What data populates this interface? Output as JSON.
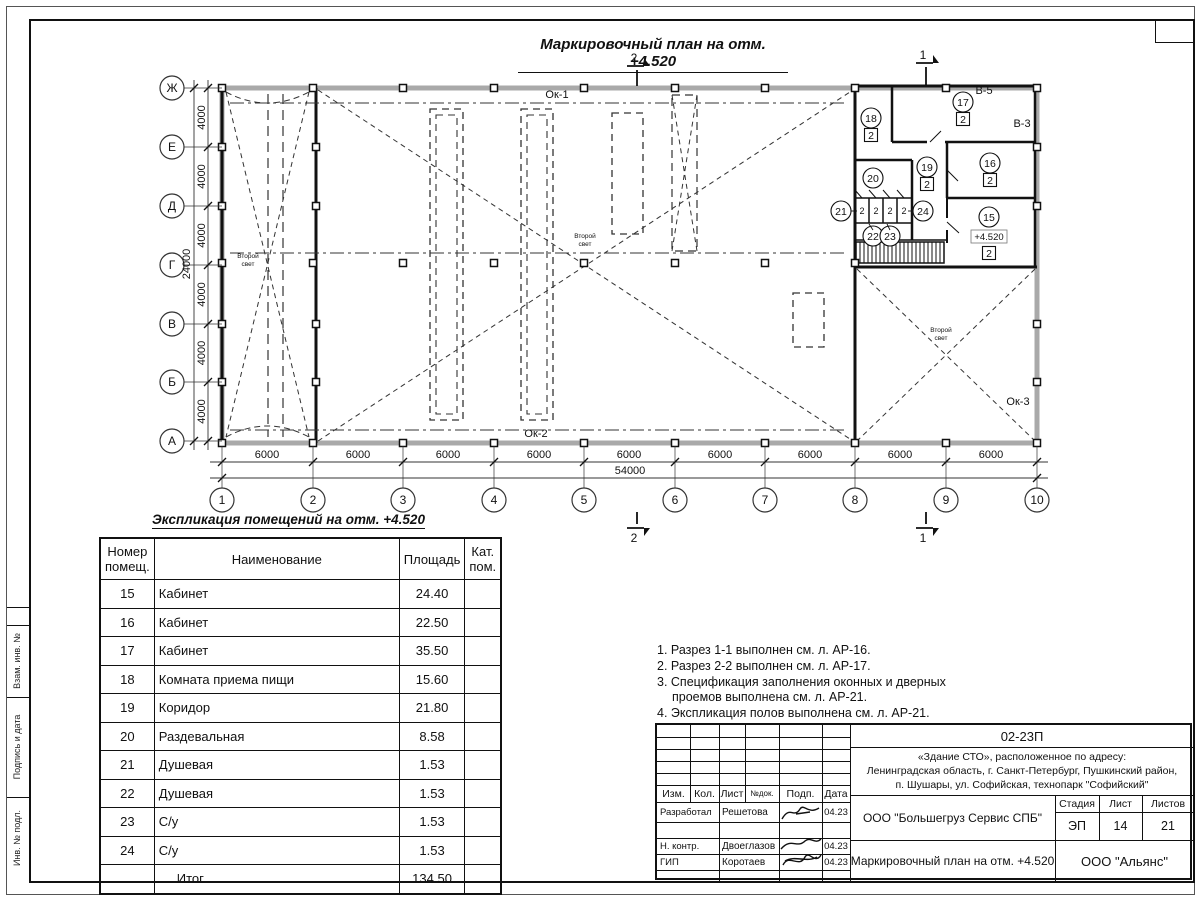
{
  "frame": {
    "side_labels": [
      "Взам. инв. №",
      "Подпись и дата",
      "Инв. № подл."
    ]
  },
  "plan": {
    "title": "Маркировочный план на отм. +4.520",
    "axes_rows": [
      "Ж",
      "Е",
      "Д",
      "Г",
      "В",
      "Б",
      "А"
    ],
    "axes_cols": [
      "1",
      "2",
      "3",
      "4",
      "5",
      "6",
      "7",
      "8",
      "9",
      "10"
    ],
    "dim_bay_h": "6000",
    "dim_total_h": "54000",
    "dim_bay_v": "4000",
    "dim_total_v": "24000",
    "ok1": "Ок-1",
    "ok2": "Ок-2",
    "ok3": "Ок-3",
    "b5": "В-5",
    "b3": "В-3",
    "second_light_line1": "Второй",
    "second_light_line2": "свет",
    "elevation": "+4.520",
    "floor_mark": "2",
    "section_1": "1",
    "section_2": "2",
    "room_numbers": [
      "15",
      "16",
      "17",
      "18",
      "19",
      "20",
      "21",
      "22",
      "23",
      "24"
    ]
  },
  "table": {
    "title": "Экспликация помещений на отм. +4.520",
    "headers": [
      "Номер\nпомещ.",
      "Наименование",
      "Площадь",
      "Кат.\nпом."
    ],
    "rows": [
      {
        "num": "15",
        "name": "Кабинет",
        "area": "24.40",
        "cat": ""
      },
      {
        "num": "16",
        "name": "Кабинет",
        "area": "22.50",
        "cat": ""
      },
      {
        "num": "17",
        "name": "Кабинет",
        "area": "35.50",
        "cat": ""
      },
      {
        "num": "18",
        "name": "Комната приема пищи",
        "area": "15.60",
        "cat": ""
      },
      {
        "num": "19",
        "name": "Коридор",
        "area": "21.80",
        "cat": ""
      },
      {
        "num": "20",
        "name": "Раздевальная",
        "area": "8.58",
        "cat": ""
      },
      {
        "num": "21",
        "name": "Душевая",
        "area": "1.53",
        "cat": ""
      },
      {
        "num": "22",
        "name": "Душевая",
        "area": "1.53",
        "cat": ""
      },
      {
        "num": "23",
        "name": "С/у",
        "area": "1.53",
        "cat": ""
      },
      {
        "num": "24",
        "name": "С/у",
        "area": "1.53",
        "cat": ""
      }
    ],
    "total": {
      "num": "",
      "name": "Итог",
      "area": "134.50",
      "cat": ""
    }
  },
  "notes": {
    "line1": "1. Разрез 1-1 выполнен см. л. АР-16.",
    "line2": "2. Разрез 2-2 выполнен см. л. АР-17.",
    "line3": "3. Спецификация заполнения оконных и дверных",
    "line4": "проемов выполнена см. л. АР-21.",
    "line5": "4. Экспликация полов выполнена см. л. АР-21."
  },
  "titleblock": {
    "doc_number": "02-23П",
    "address_line1": "«Здание СТО», расположенное по адресу:",
    "address_line2": "Ленинградская область, г. Санкт-Петербург, Пушкинский район,",
    "address_line3": "п. Шушары, ул. Софийская, технопарк \"Софийский\"",
    "col_izm": "Изм.",
    "col_kol": "Кол.",
    "col_list": "Лист",
    "col_doc": "№док.",
    "col_podp": "Подп.",
    "col_data": "Дата",
    "role_developed": "Разработал",
    "name_developed": "Решетова",
    "date_developed": "04.23",
    "role_ncontr": "Н. контр.",
    "name_ncontr": "Двоеглазов",
    "date_ncontr": "04.23",
    "role_gip": "ГИП",
    "name_gip": "Коротаев",
    "date_gip": "04.23",
    "company": "ООО \"Большегруз Сервис СПБ\"",
    "stage_label": "Стадия",
    "sheet_label": "Лист",
    "sheets_label": "Листов",
    "stage": "ЭП",
    "sheet": "14",
    "sheets": "21",
    "drawing_title": "Маркировочный план на отм. +4.520",
    "org": "ООО \"Альянс\""
  }
}
